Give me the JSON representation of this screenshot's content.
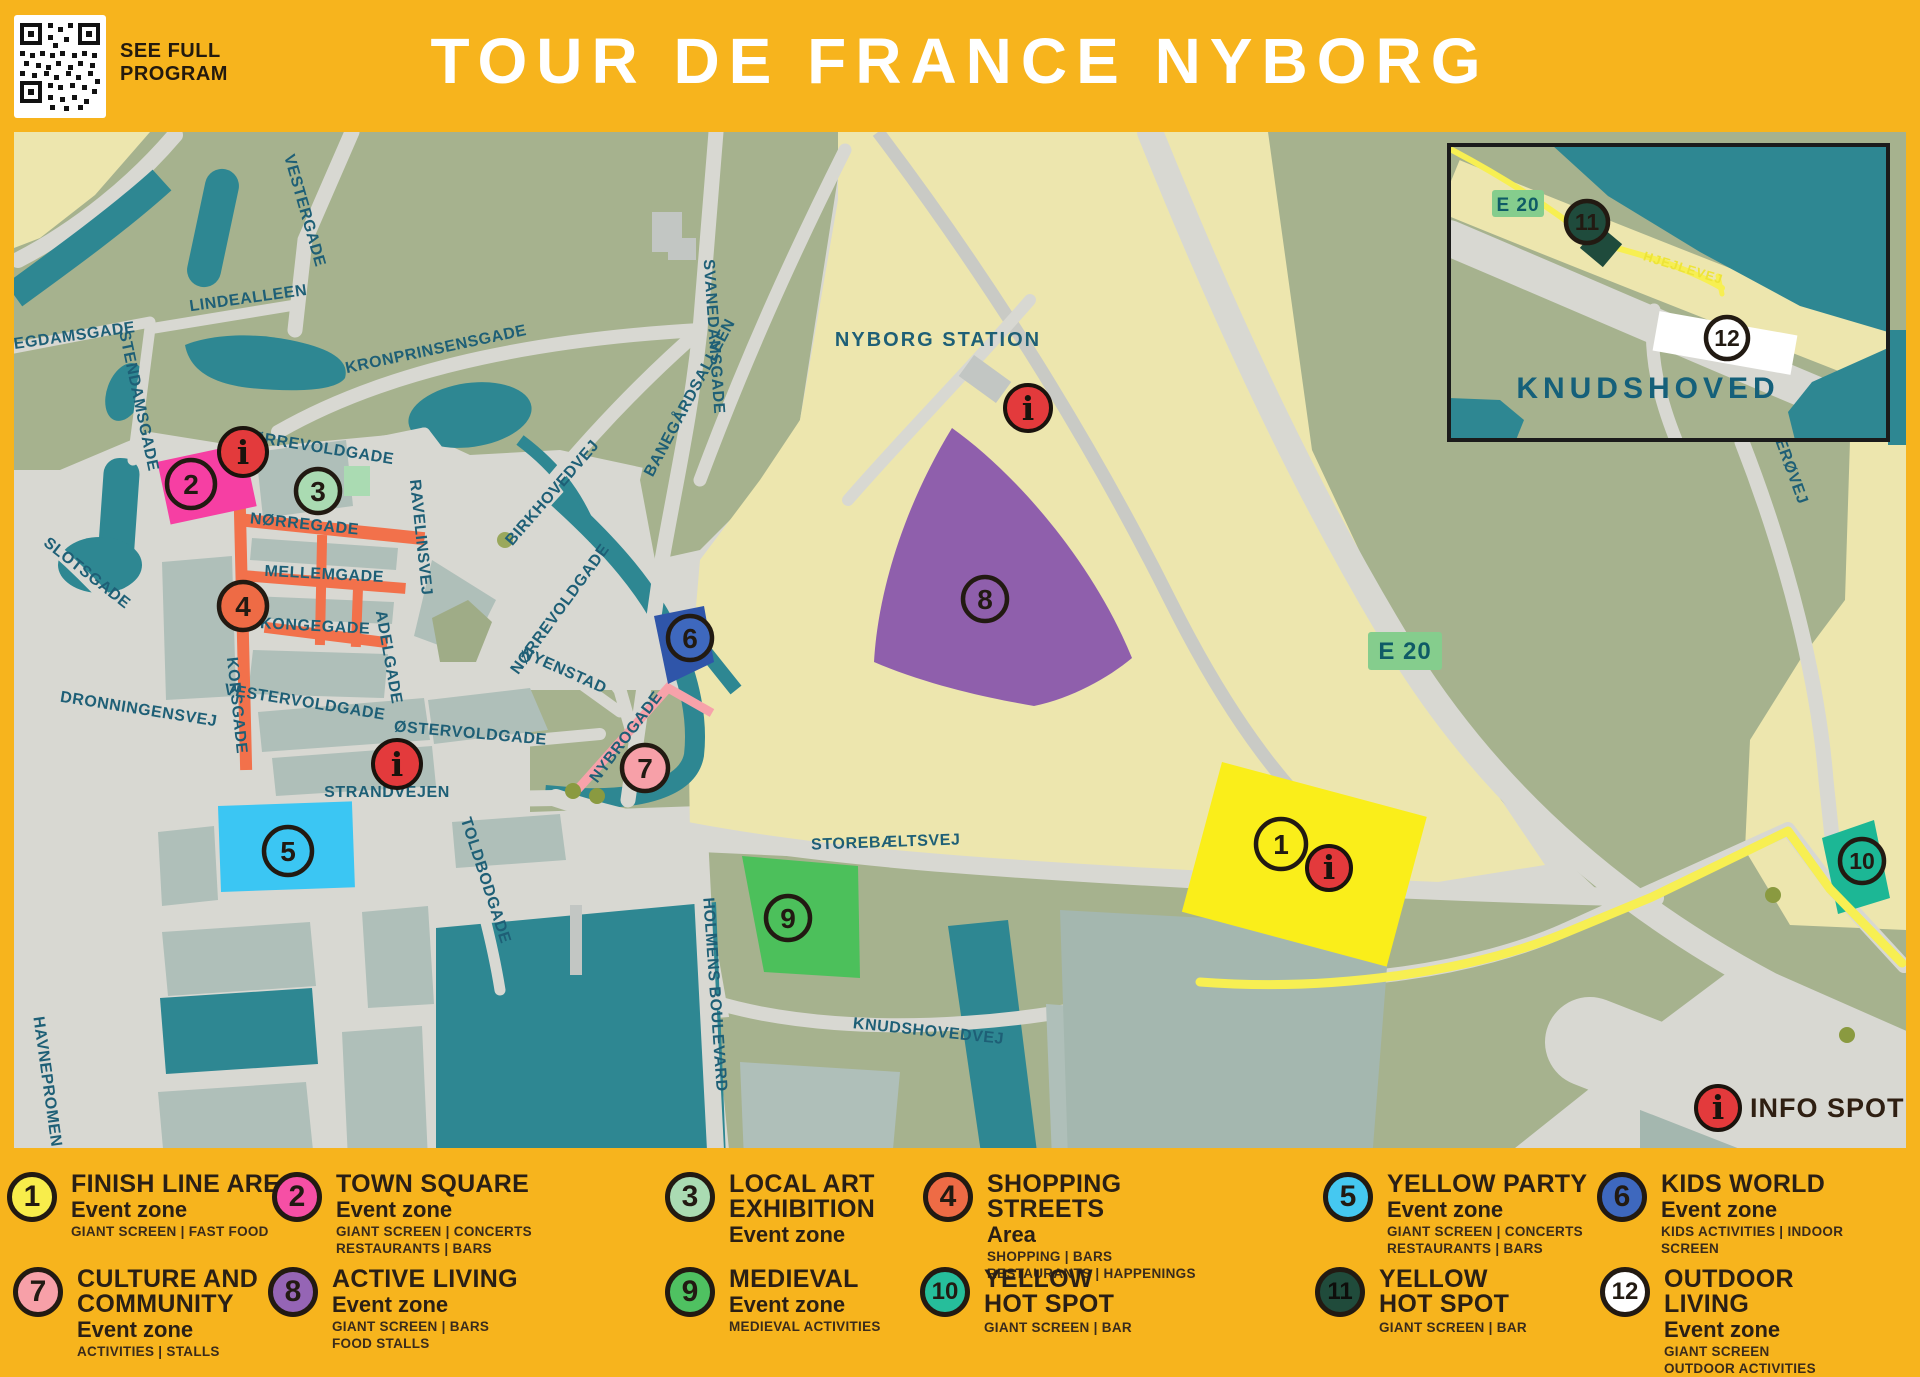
{
  "header": {
    "qr_label": "SEE FULL\nPROGRAM",
    "title": "TOUR DE FRANCE NYBORG"
  },
  "theme": {
    "background_yellow": "#F7B41D",
    "map_road_gray": "#D8D8D2",
    "land_green": "#A6B28E",
    "water_teal": "#2E8792",
    "area_beige": "#EDE6AE",
    "block_bluegray": "#AFBFB9",
    "street_label_blue": "#1E5F76",
    "shopping_street_orange": "#F2714B",
    "route_yellow": "#F7EF52",
    "info_red": "#E33A3C",
    "ink": "#221A12"
  },
  "map": {
    "streets": {
      "vestergade": "VESTERGADE",
      "lindealleen": "LINDEALLEEN",
      "blegdamsgade": "BLEGDAMSGADE",
      "stendamsgade": "STENDAMSGADE",
      "kronprinsensgade": "KRONPRINSENSGADE",
      "norrevoldgade": "NØRREVOLDGADE",
      "norregade": "NØRREGADE",
      "mellemgade": "MELLEMGADE",
      "kongegade": "KONGEGADE",
      "ravelinsvej": "RAVELINSVEJ",
      "adelgade": "ADELGADE",
      "birkhovedvej": "BIRKHOVEDVEJ",
      "korsgade": "KORSGADE",
      "slotsgade": "SLOTSGADE",
      "dronningensvej": "DRONNINGENSVEJ",
      "vestervoldgade": "VESTERVOLDGADE",
      "ostervoldgade": "ØSTERVOLDGADE",
      "strandvejen": "STRANDVEJEN",
      "nyenstad": "NYENSTAD",
      "nybrogade": "NYBROGADE",
      "svanedamsgade": "SVANEDAMSGADE",
      "banegardsalleen": "BANEGÅRDSALLEEN",
      "storebaeltsvej": "STOREBÆLTSVEJ",
      "holmens_boulevard": "HOLMENS BOULEVARD",
      "knudshovedvej": "KNUDSHOVEDVEJ",
      "toldbodgade": "TOLDBODGADE",
      "havnepromenade": "HAVNEPROMENADE",
      "erovej": "ERØVEJ",
      "hjejlevej": "HJEJLEVEJ"
    },
    "places": {
      "nyborg_station": "NYBORG STATION",
      "knudshoved": "KNUDSHOVED",
      "e20": "E 20",
      "info_spot": "INFO SPOT"
    },
    "marker_labels": [
      "1",
      "2",
      "3",
      "4",
      "5",
      "6",
      "7",
      "8",
      "9",
      "10",
      "11",
      "12"
    ]
  },
  "legend": {
    "items": [
      {
        "num": "1",
        "color": "#F8ED4B",
        "title": "FINISH LINE AREA",
        "subtitle": "Event zone",
        "details": "GIANT SCREEN | FAST FOOD"
      },
      {
        "num": "2",
        "color": "#F64FA5",
        "title": "TOWN SQUARE",
        "subtitle": "Event zone",
        "details": "GIANT SCREEN | CONCERTS\nRESTAURANTS | BARS"
      },
      {
        "num": "3",
        "color": "#AADBB2",
        "title": "LOCAL ART\nEXHIBITION",
        "subtitle": "Event zone",
        "details": ""
      },
      {
        "num": "4",
        "color": "#EE6B45",
        "title": "SHOPPING\nSTREETS",
        "subtitle": "Area",
        "details": "SHOPPING | BARS\nRESTAURANTS | HAPPENINGS"
      },
      {
        "num": "5",
        "color": "#45C8F1",
        "title": "YELLOW PARTY",
        "subtitle": "Event zone",
        "details": "GIANT SCREEN | CONCERTS\nRESTAURANTS | BARS"
      },
      {
        "num": "6",
        "color": "#3E68BE",
        "title": "KIDS WORLD",
        "subtitle": "Event zone",
        "details": "KIDS ACTIVITIES | INDOOR\nSCREEN"
      },
      {
        "num": "7",
        "color": "#F7A0A8",
        "title": "CULTURE AND\nCOMMUNITY",
        "subtitle": "Event zone",
        "details": "ACTIVITIES | STALLS"
      },
      {
        "num": "8",
        "color": "#9565B5",
        "title": "ACTIVE LIVING",
        "subtitle": "Event zone",
        "details": "GIANT SCREEN | BARS\nFOOD STALLS"
      },
      {
        "num": "9",
        "color": "#4FC161",
        "title": "MEDIEVAL",
        "subtitle": "Event zone",
        "details": "MEDIEVAL ACTIVITIES"
      },
      {
        "num": "10",
        "color": "#26BE9B",
        "title": "YELLOW\nHOT SPOT",
        "subtitle": "",
        "details": "GIANT SCREEN | BAR"
      },
      {
        "num": "11",
        "color": "#204B3B",
        "title": "YELLOW\nHOT SPOT",
        "subtitle": "",
        "details": "GIANT SCREEN | BAR"
      },
      {
        "num": "12",
        "color": "#FFFFFF",
        "title": "OUTDOOR\nLIVING",
        "subtitle": "Event zone",
        "details": "GIANT SCREEN\nOUTDOOR ACTIVITIES"
      }
    ]
  }
}
